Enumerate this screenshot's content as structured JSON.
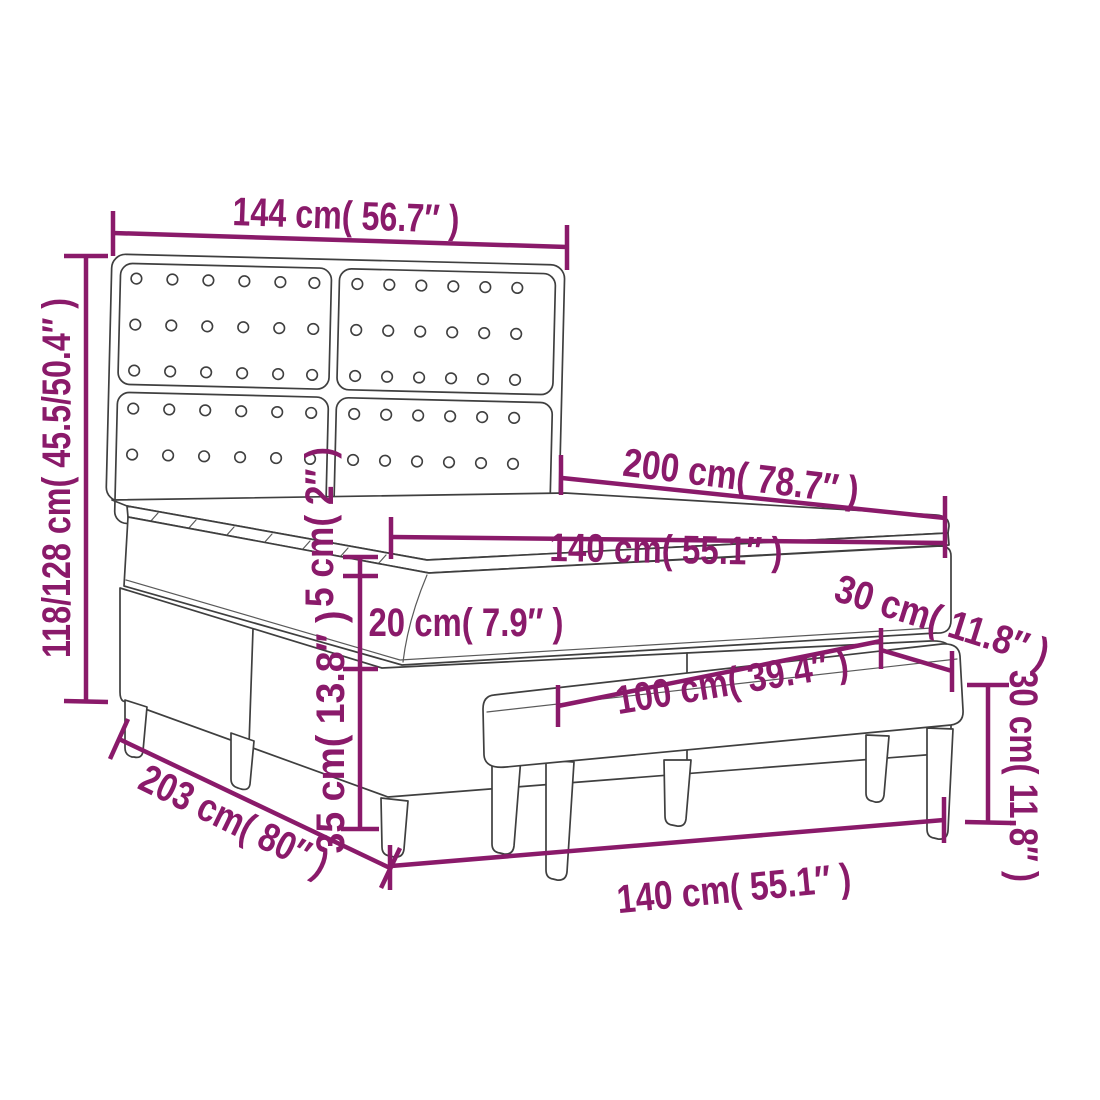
{
  "page": {
    "description": "Technical dimension diagram of a box spring bed with tufted headboard, mattress topper and matching bench"
  },
  "colors": {
    "dimension": "#8a1a6a",
    "outline": "#3f3f3f",
    "background": "#ffffff"
  },
  "diagram": {
    "dimensions": {
      "headboard_width": "144 cm( 56.7″ )",
      "bed_height": "118/128 cm( 45.5/50.4″ )",
      "bed_length": "200 cm( 78.7″ )",
      "mattress_width": "140 cm( 55.1″ )",
      "topper_thickness": "5 cm( 2″ )",
      "mattress_thickness": "20 cm( 7.9″ )",
      "base_height": "35 cm( 13.8″ )",
      "bench_depth": "30 cm( 11.8″ )",
      "bench_length": "100 cm( 39.4″ )",
      "bench_height": "30 cm( 11.8″ )",
      "total_length": "203 cm( 80″ )",
      "bed_width": "140 cm( 55.1″ )"
    }
  }
}
